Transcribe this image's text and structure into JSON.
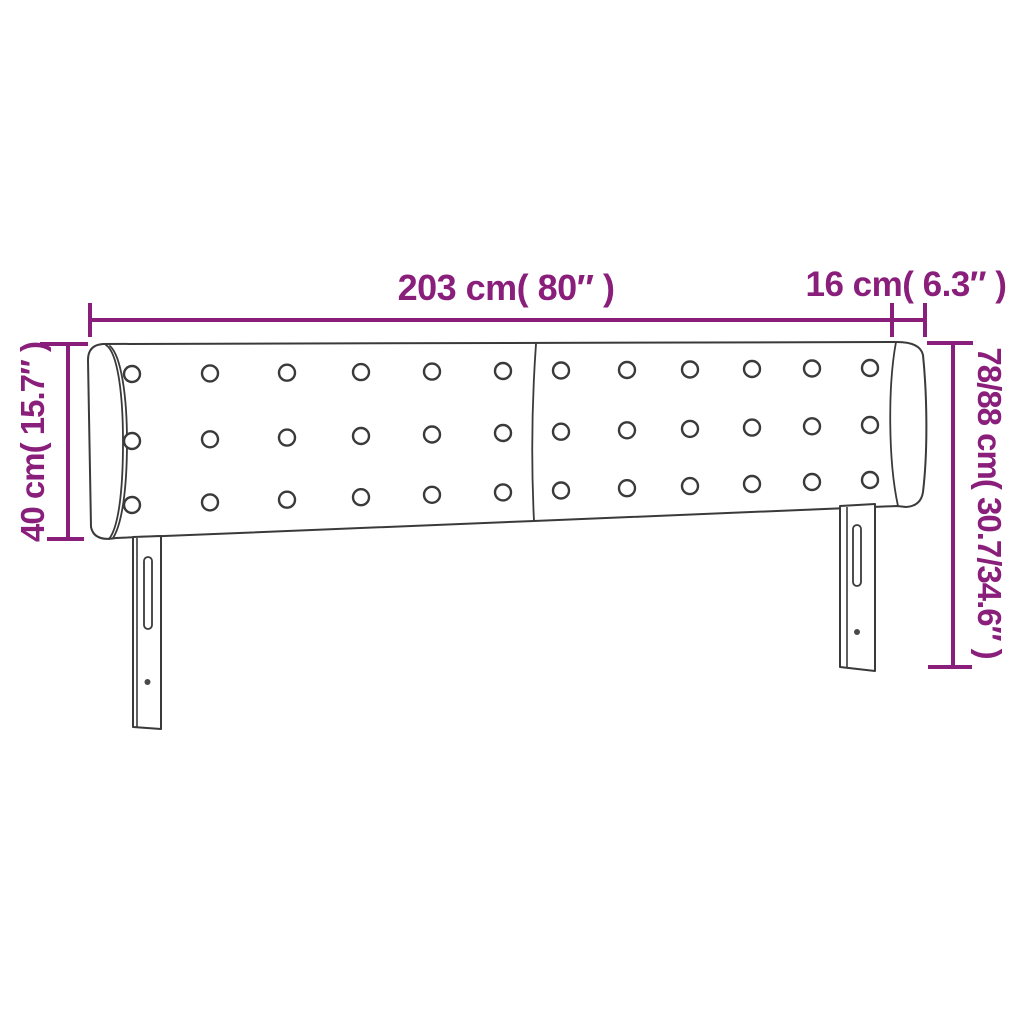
{
  "product_diagram": {
    "subject": "upholstered headboard with side wings, tufting buttons and two slotted mounting legs",
    "dimension_labels": {
      "total_width": "203 cm( 80″ )",
      "wing_depth": "16 cm( 6.3″ )",
      "headboard_height": "40 cm( 15.7″ )",
      "total_height": "78/88 cm( 30.7/34.6″ )"
    },
    "colors": {
      "dimension_accent": "#8a1f7b",
      "drawing_outline": "#3a3a3a",
      "background": "#ffffff"
    },
    "tufting": {
      "button_rows": 3,
      "buttons_per_row": 12,
      "panels": 2
    }
  }
}
